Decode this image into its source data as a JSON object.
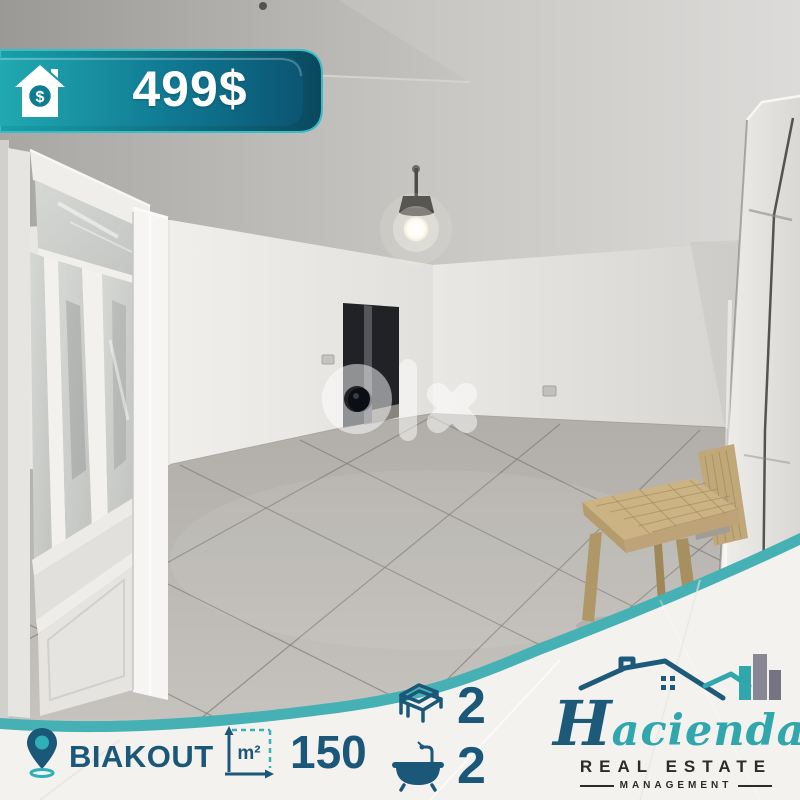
{
  "price_banner": {
    "price": "499$",
    "icon": "house-dollar-icon",
    "symbol": "$"
  },
  "watermark": {
    "text": "olx"
  },
  "listing": {
    "location": "BIAKOUT",
    "area": "150",
    "area_unit": "m²",
    "bedrooms": "2",
    "bathrooms": "2"
  },
  "brand": {
    "initial": "H",
    "name_rest": "acienda",
    "line1": "REAL ESTATE",
    "line2": "MANAGEMENT"
  },
  "colors": {
    "teal": "#2fa7ac",
    "dark_blue": "#1b5778",
    "banner_gradient_dark": "#0b5573",
    "white_band": "#f3f2ef"
  }
}
